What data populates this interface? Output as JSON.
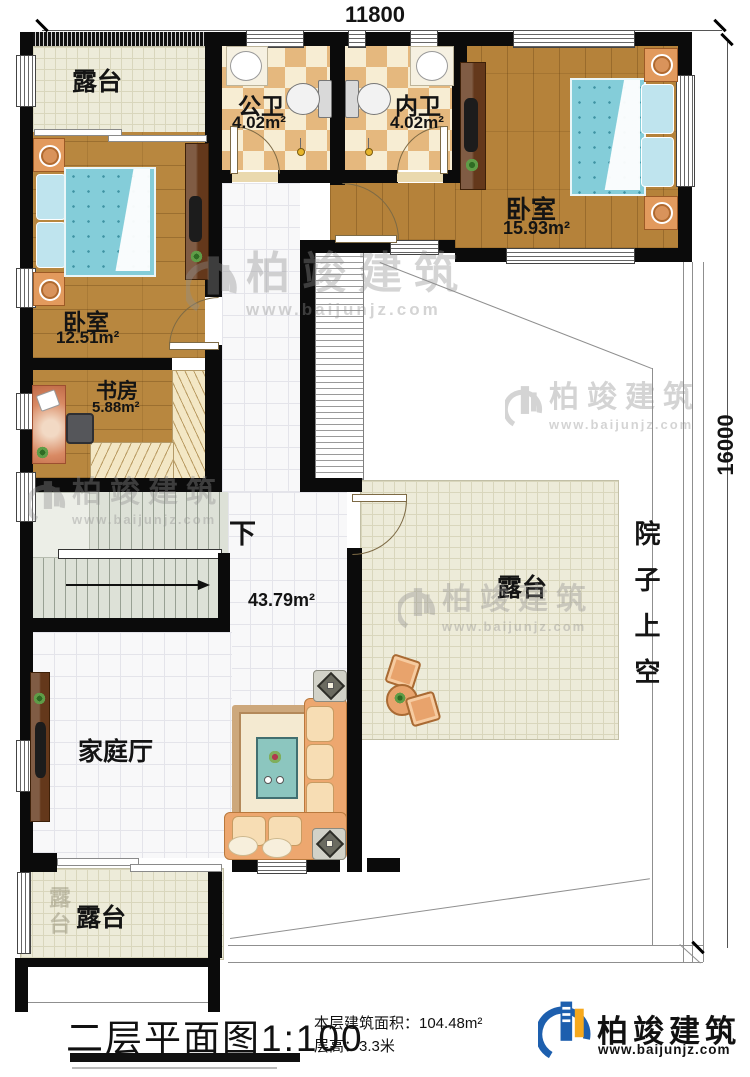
{
  "dimensions": {
    "top": "11800",
    "right": "16000"
  },
  "rooms": {
    "terrace_top_left": {
      "name": "露台"
    },
    "public_bath": {
      "name": "公卫",
      "area": "4.02m²"
    },
    "ensuite_bath": {
      "name": "内卫",
      "area": "4.02m²"
    },
    "bedroom_right": {
      "name": "卧室",
      "area": "15.93m²"
    },
    "bedroom_left": {
      "name": "卧室",
      "area": "12.51m²"
    },
    "study": {
      "name": "书房",
      "area": "5.88m²"
    },
    "stair": {
      "down": "下"
    },
    "hall": {
      "name": "家庭厅",
      "area": "43.79m²"
    },
    "terrace_mid": {
      "name": "露台"
    },
    "terrace_bottom": {
      "name": "露台"
    },
    "courtyard": {
      "name": "院子上空"
    }
  },
  "watermark": {
    "brand": "柏竣建筑",
    "site": "www.baijunjz.com"
  },
  "footer": {
    "title": "二层平面图",
    "scale": "1:100",
    "area_line": "本层建筑面积：104.48m²",
    "height_line": "层高：3.3米",
    "brand": "柏竣建筑",
    "site": "www.baijunjz.com"
  },
  "colors": {
    "accent_blue": "#1d5fae",
    "accent_orange": "#f6a81c",
    "wall": "#0b0b0b"
  }
}
